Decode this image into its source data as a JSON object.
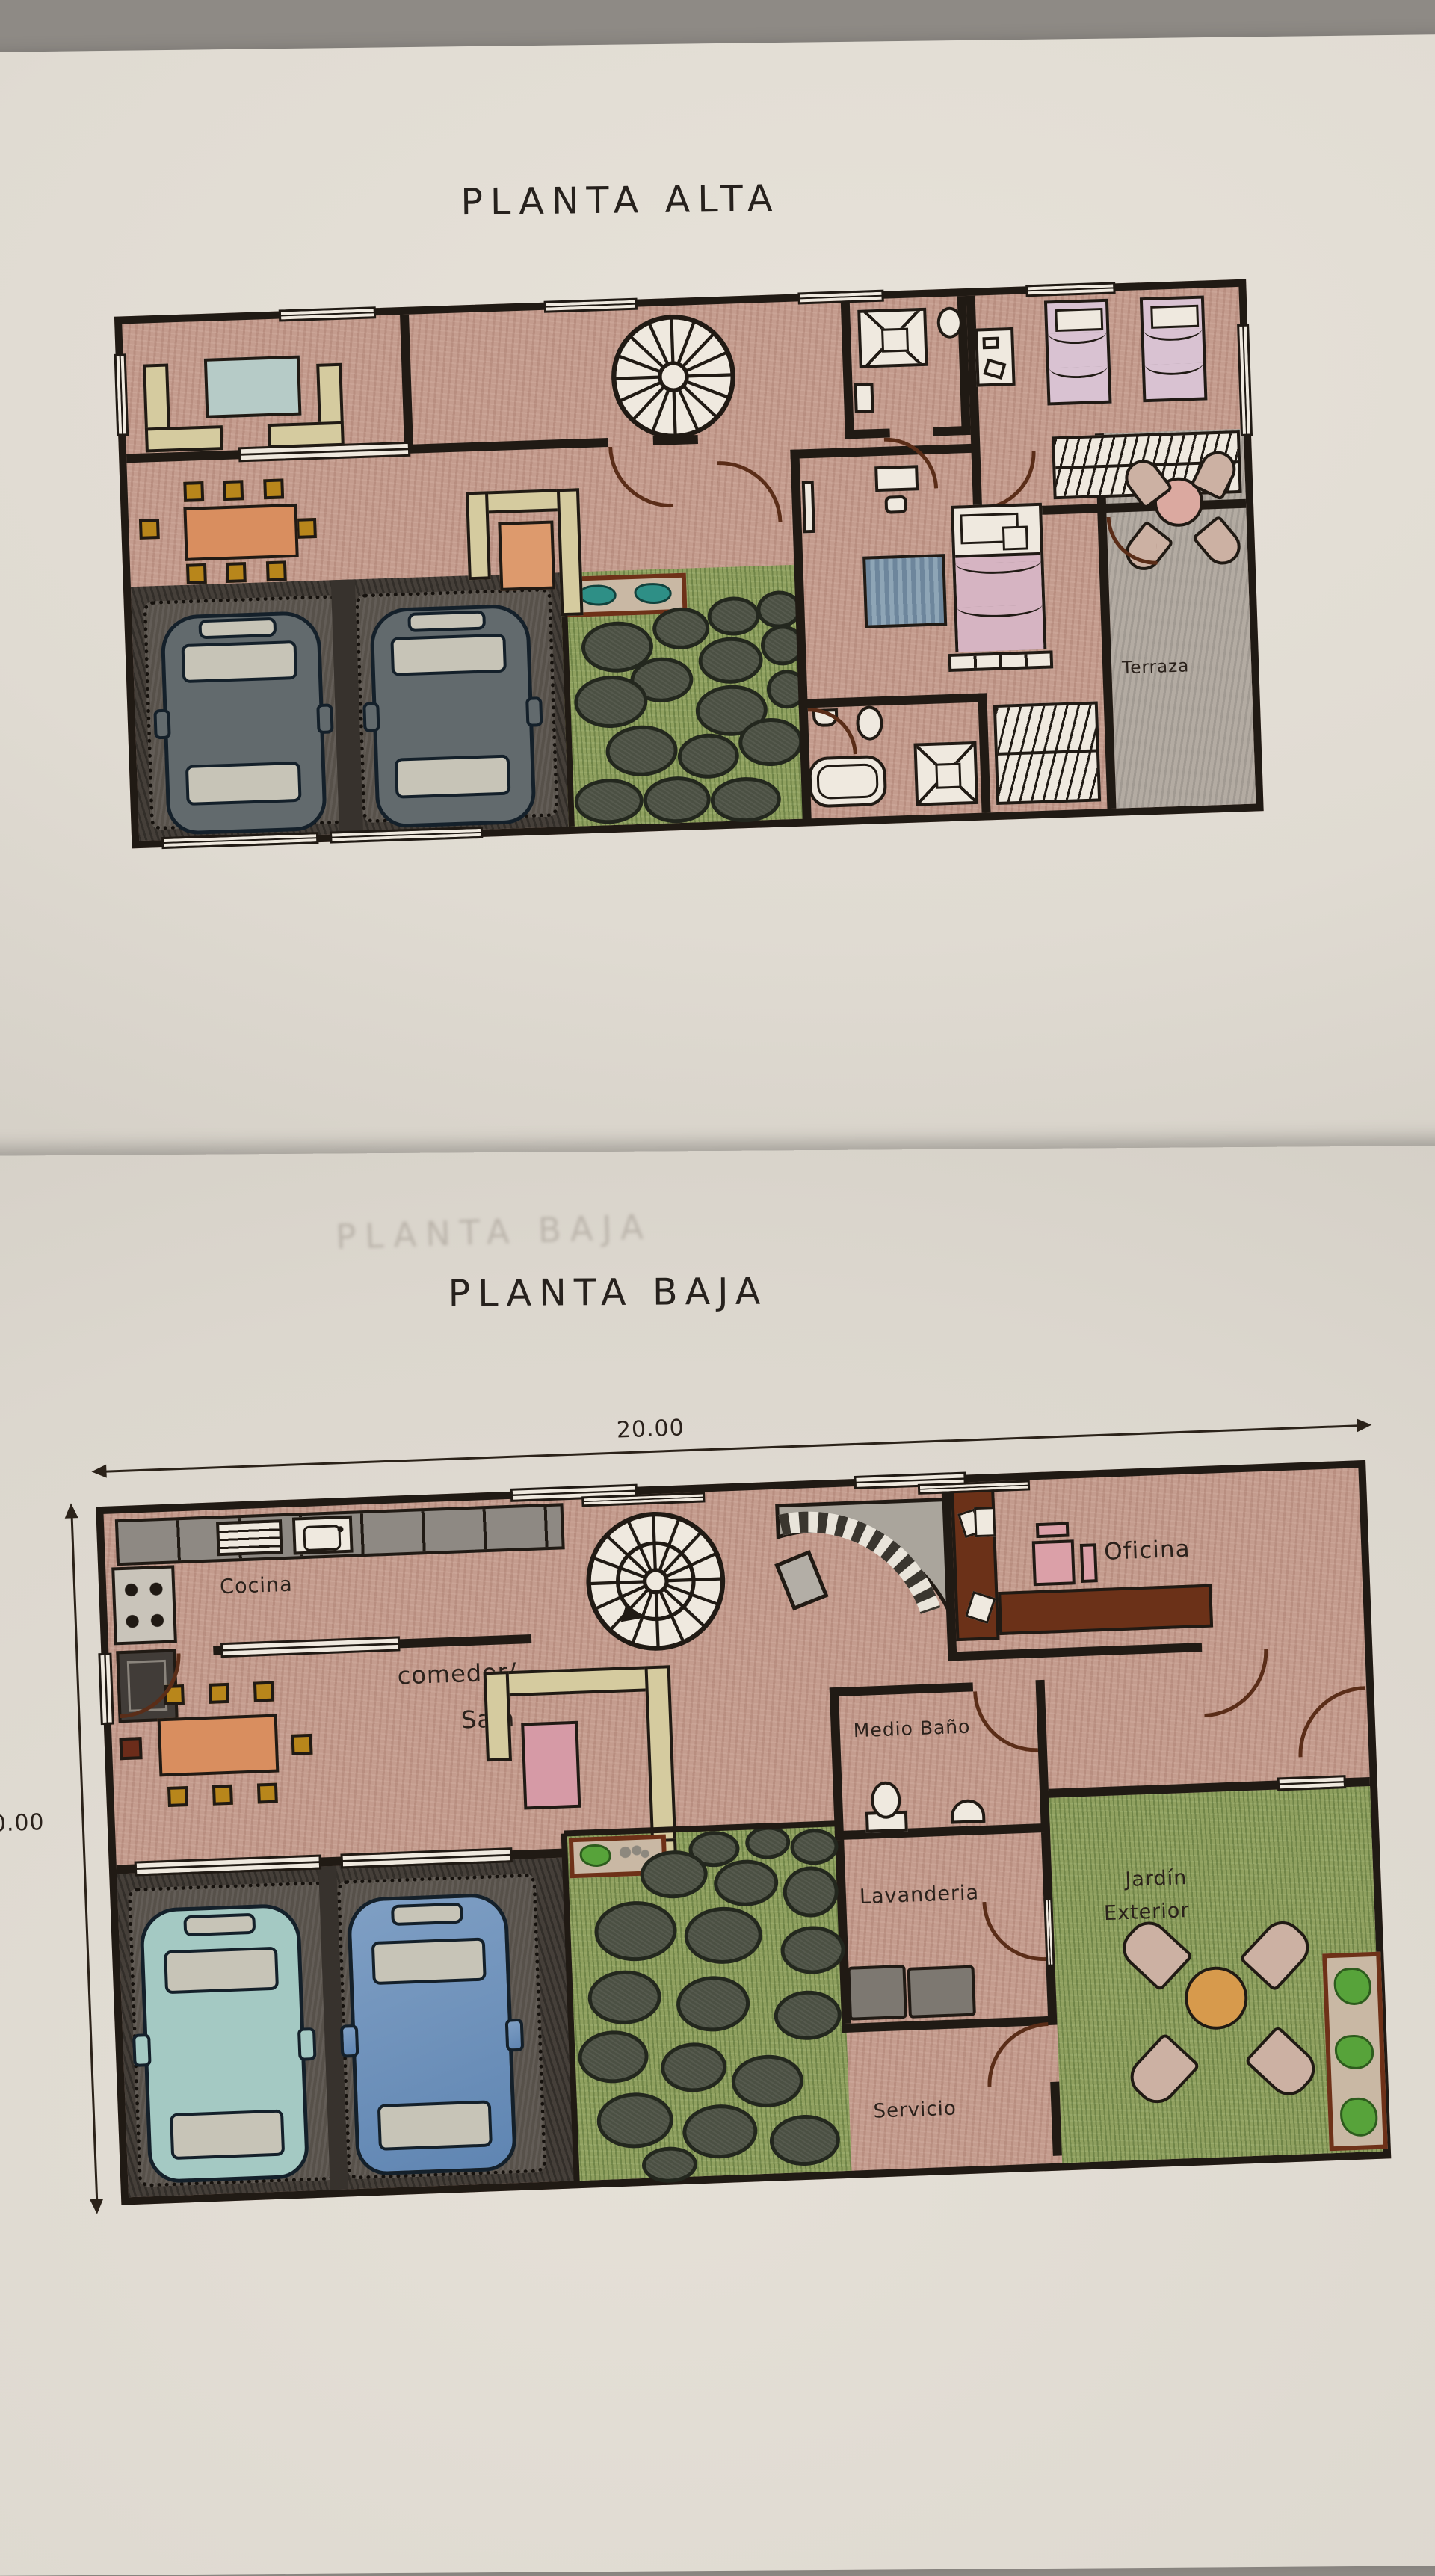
{
  "alta": {
    "title": "PLANTA ALTA",
    "labels": {
      "terraza": "Terraza"
    }
  },
  "baja": {
    "ghost_title": "PLANTA BAJA",
    "title": "PLANTA BAJA",
    "dimensions": {
      "width_label": "20.00",
      "height_label": "10.00"
    },
    "labels": {
      "cocina": "Cocina",
      "comedor": "comedor/",
      "sala": "Sala",
      "oficina": "Oficina",
      "medio_bano": "Medio Baño",
      "lavanderia": "Lavanderia",
      "servicio": "Servicio",
      "jardin1": "Jardín",
      "jardin2": "Exterior"
    }
  },
  "colors": {
    "paper": "#e0dbd2",
    "ink": "#201a14",
    "floor_pink": "#c49c8e",
    "grass_green": "#8fa05f",
    "garage_dark": "#453f39",
    "sofa_cream": "#d5cb9f",
    "table_orange": "#d98e5f",
    "car_teal": "#a4c9c3",
    "car_blue": "#7396bd"
  }
}
